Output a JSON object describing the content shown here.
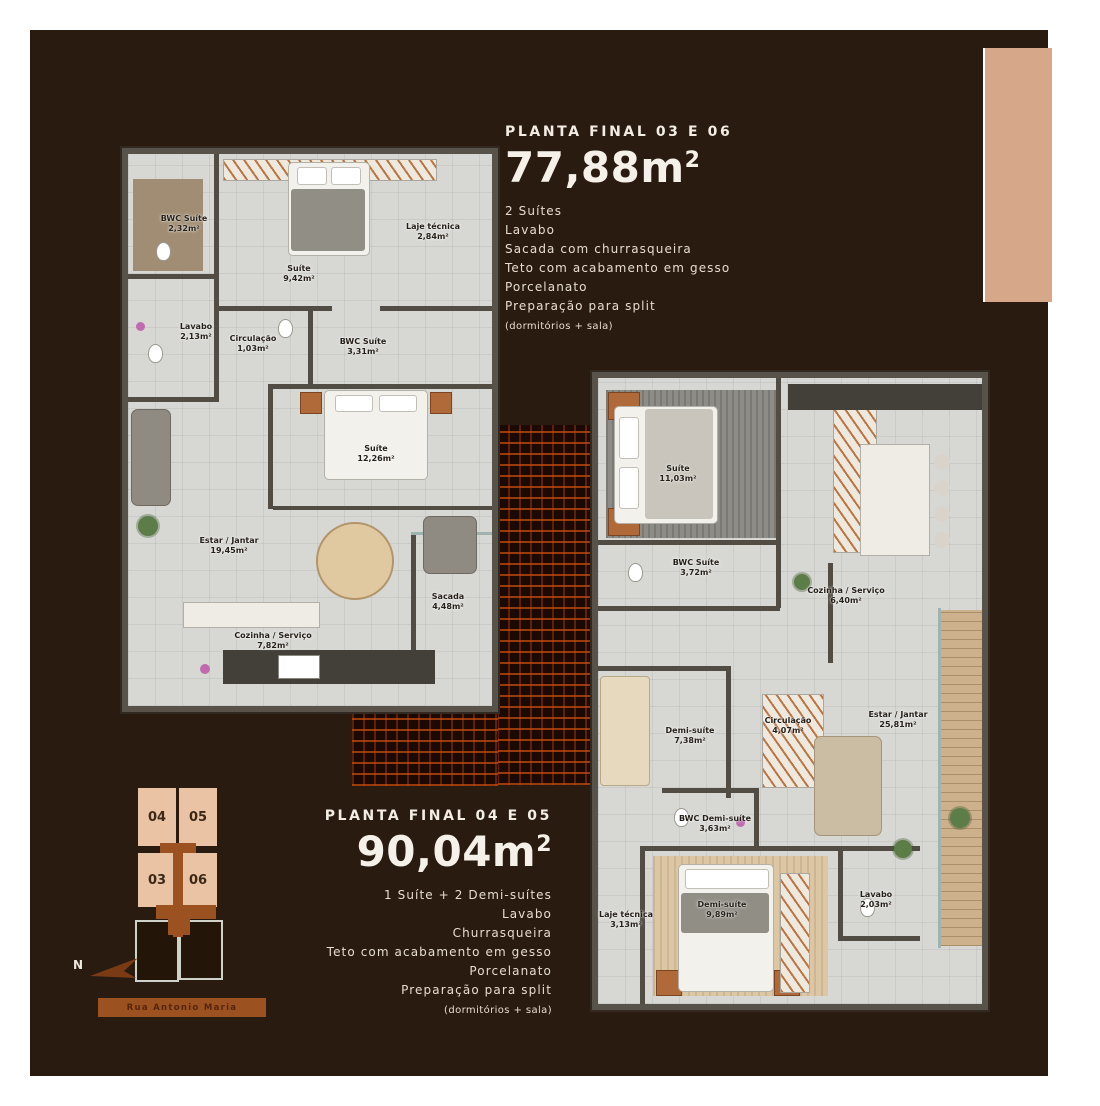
{
  "colors": {
    "background": "#2a1b11",
    "accent_peach": "#d7a78a",
    "brick_orange": "#cd4e10",
    "keyplan_unit": "#e9c3a4",
    "banner_brown": "#9c5220"
  },
  "plan1": {
    "title": "PLANTA FINAL 03 E 06",
    "area": "77,88",
    "unit": "m",
    "sup": "2",
    "features": [
      "2 Suítes",
      "Lavabo",
      "Sacada com churrasqueira",
      "Teto com acabamento em gesso",
      "Porcelanato",
      "Preparação para split"
    ],
    "note": "(dormitórios + sala)",
    "rooms": {
      "bwc_suite_1": {
        "name": "BWC Suíte",
        "area": "2,32m²"
      },
      "suite_1": {
        "name": "Suíte",
        "area": "9,42m²"
      },
      "laje_tecnica": {
        "name": "Laje técnica",
        "area": "2,84m²"
      },
      "lavabo": {
        "name": "Lavabo",
        "area": "2,13m²"
      },
      "circulacao": {
        "name": "Circulação",
        "area": "1,03m²"
      },
      "bwc_suite_2": {
        "name": "BWC Suíte",
        "area": "3,31m²"
      },
      "suite_2": {
        "name": "Suíte",
        "area": "12,26m²"
      },
      "estar_jantar": {
        "name": "Estar / Jantar",
        "area": "19,45m²"
      },
      "sacada": {
        "name": "Sacada",
        "area": "4,48m²"
      },
      "cozinha": {
        "name": "Cozinha / Serviço",
        "area": "7,82m²"
      }
    }
  },
  "plan2": {
    "title": "PLANTA FINAL 04 E 05",
    "area": "90,04",
    "unit": "m",
    "sup": "2",
    "features": [
      "1 Suíte + 2 Demi-suítes",
      "Lavabo",
      "Churrasqueira",
      "Teto com acabamento em gesso",
      "Porcelanato",
      "Preparação para split"
    ],
    "note": "(dormitórios + sala)",
    "rooms": {
      "suite": {
        "name": "Suíte",
        "area": "11,03m²"
      },
      "bwc_suite": {
        "name": "BWC Suíte",
        "area": "3,72m²"
      },
      "cozinha": {
        "name": "Cozinha / Serviço",
        "area": "6,40m²"
      },
      "demi_suite_1": {
        "name": "Demi-suíte",
        "area": "7,38m²"
      },
      "circulacao": {
        "name": "Circulação",
        "area": "4,07m²"
      },
      "estar_jantar": {
        "name": "Estar / Jantar",
        "area": "25,81m²"
      },
      "bwc_demi": {
        "name": "BWC Demi-suíte",
        "area": "3,63m²"
      },
      "demi_suite_2": {
        "name": "Demi-suíte",
        "area": "9,89m²"
      },
      "lavabo": {
        "name": "Lavabo",
        "area": "2,03m²"
      },
      "laje_tecnica": {
        "name": "Laje técnica",
        "area": "3,13m²"
      }
    }
  },
  "keyplan": {
    "unit_top_left": "04",
    "unit_top_right": "05",
    "unit_bottom_left": "03",
    "unit_bottom_right": "06",
    "north": "N",
    "street": "Rua Antonio Maria"
  }
}
